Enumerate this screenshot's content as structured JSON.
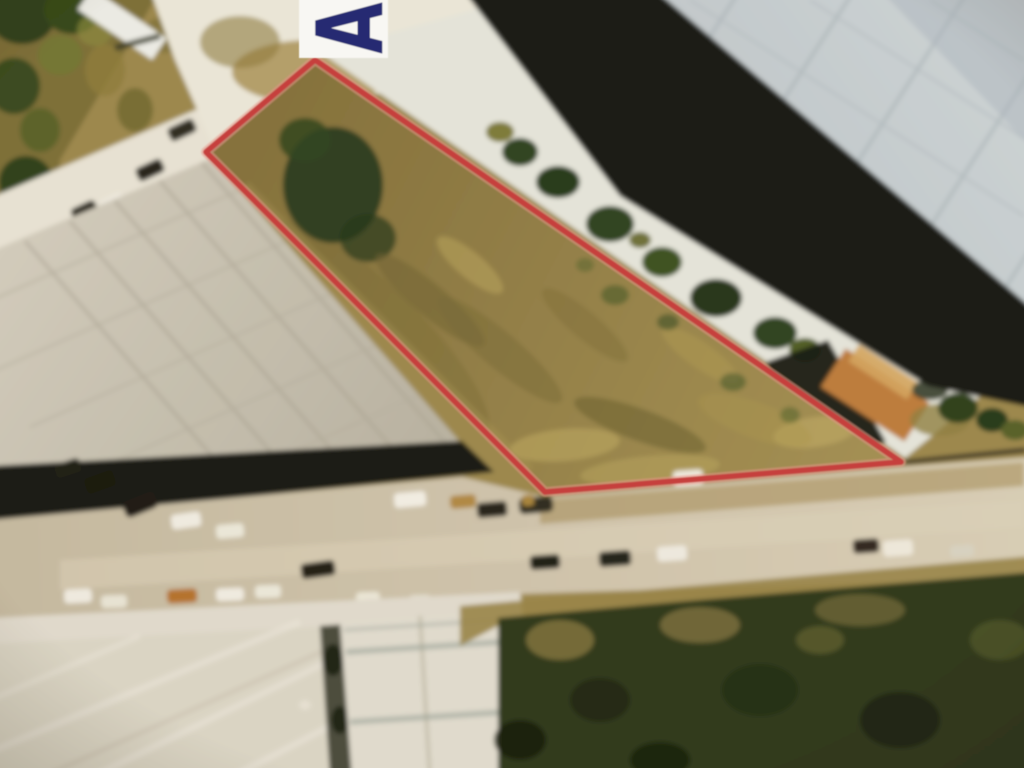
{
  "photo": {
    "marker": {
      "label": "A",
      "text_color": "#272c72",
      "box_color": "#f8f7f3"
    },
    "parcel_outline": {
      "color": "#c6413c",
      "glow_color": "#e9958a",
      "points": "315,60 206,152 545,492 901,462"
    },
    "palette": {
      "ground_base": "#9b8850",
      "parcel_dirt": "#8f7c46",
      "left_roof": "#cac6b8",
      "right_roof": "#c7d1d7",
      "bottom_roof": "#dcd8cb",
      "road": "#cfc6b0",
      "shadow": "#151a11",
      "trees": "#2a361d",
      "bright_ground": "#eceadf"
    }
  }
}
